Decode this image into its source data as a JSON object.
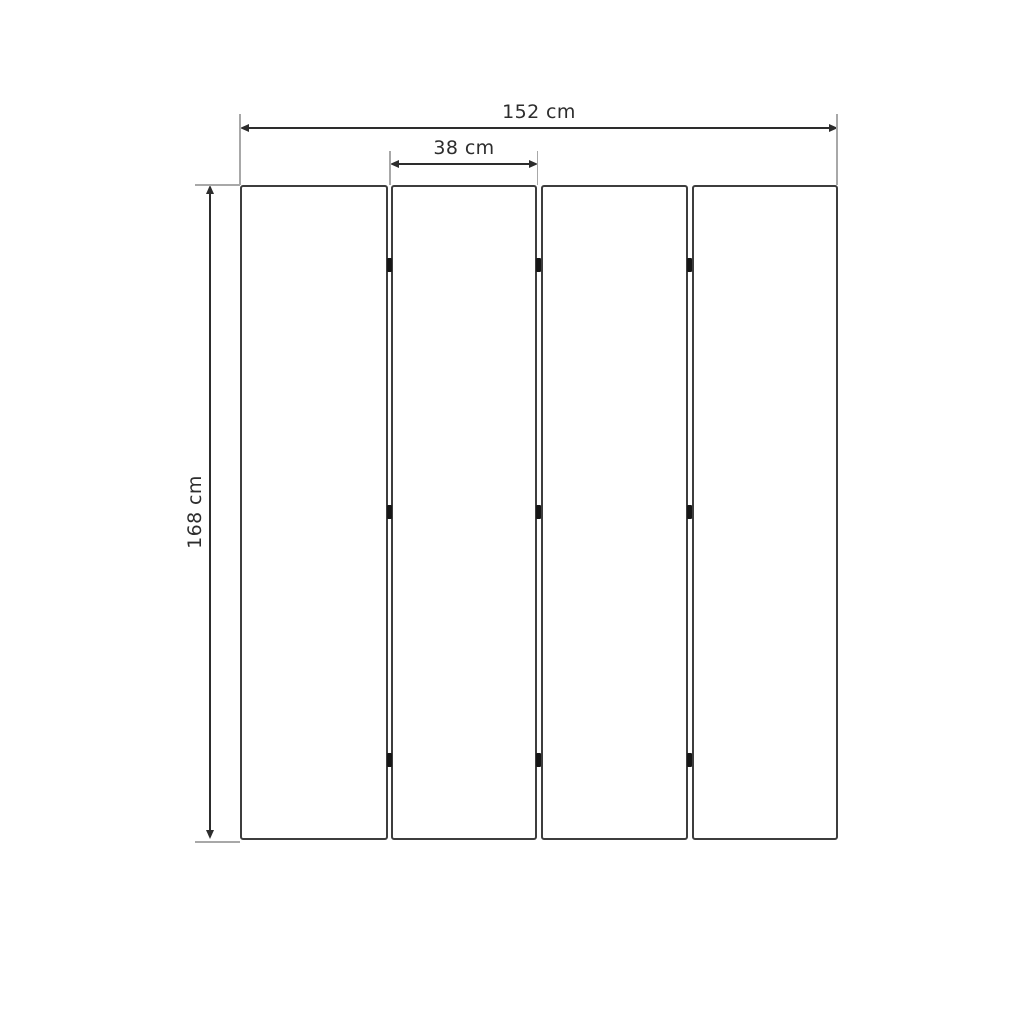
{
  "diagram": {
    "dimensions": {
      "total_width_label": "152 cm",
      "panel_width_label": "38 cm",
      "height_label": "168 cm"
    },
    "panel_count": "4",
    "hinge_count": "9",
    "colors": {
      "background": "#ffffff",
      "dimension_line": "#2d2d2d",
      "extension_line": "#a8a8a8",
      "panel_border": "#3d3d3d",
      "hinge": "#161616",
      "label_text": "#2d2d2d"
    }
  }
}
